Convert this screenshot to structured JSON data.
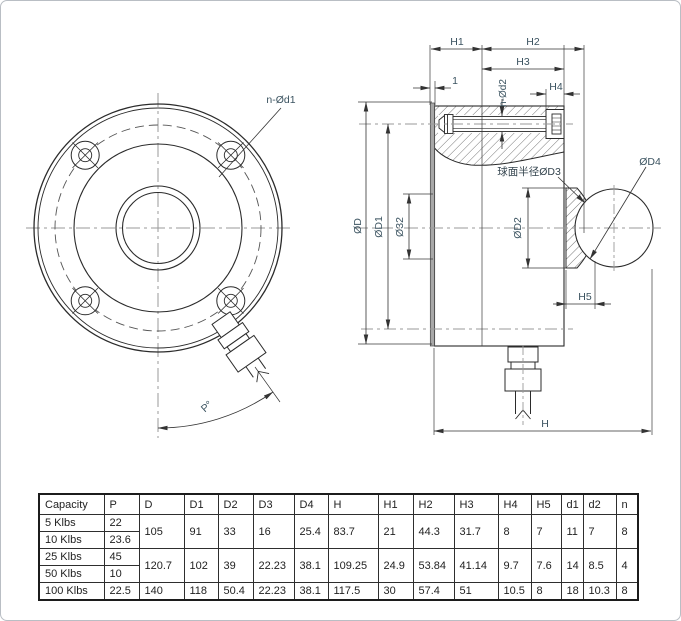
{
  "drawing": {
    "labels": {
      "n_d1": "n-Ød1",
      "p_angle": "P°",
      "h1": "H1",
      "h2": "H2",
      "h3": "H3",
      "h4": "H4",
      "h5": "H5",
      "h": "H",
      "one": "1",
      "n_d2": "n-Ød2",
      "dia_D": "ØD",
      "dia_D1": "ØD1",
      "dia_32": "Ø32",
      "dia_D2": "ØD2",
      "sphere_radius_d3": "球面半径ØD3",
      "dia_D4": "ØD4"
    },
    "icons": {
      "front_view": "circular-flange-front-view",
      "section_view": "sectional-side-view"
    }
  },
  "table": {
    "headers": [
      "Capacity",
      "P",
      "D",
      "D1",
      "D2",
      "D3",
      "D4",
      "H",
      "H1",
      "H2",
      "H3",
      "H4",
      "H5",
      "d1",
      "d2",
      "n"
    ],
    "groups": [
      {
        "capacities": [
          {
            "name": "5 Klbs",
            "p": "22"
          },
          {
            "name": "10 Klbs",
            "p": "23.6"
          }
        ],
        "shared": [
          "105",
          "91",
          "33",
          "16",
          "25.4",
          "83.7",
          "21",
          "44.3",
          "31.7",
          "8",
          "7",
          "11",
          "7",
          "8"
        ]
      },
      {
        "capacities": [
          {
            "name": "25 Klbs",
            "p": "45"
          },
          {
            "name": "50 Klbs",
            "p": "10"
          }
        ],
        "shared": [
          "120.7",
          "102",
          "39",
          "22.23",
          "38.1",
          "109.25",
          "24.9",
          "53.84",
          "41.14",
          "9.7",
          "7.6",
          "14",
          "8.5",
          "4"
        ]
      },
      {
        "capacities": [
          {
            "name": "100 Klbs",
            "p": "22.5"
          }
        ],
        "shared": [
          "140",
          "118",
          "50.4",
          "22.23",
          "38.1",
          "117.5",
          "30",
          "57.4",
          "51",
          "10.5",
          "8",
          "18",
          "10.3",
          "8"
        ]
      }
    ]
  },
  "colors": {
    "object_line": "#2b2b2b",
    "dim_line": "#3a3a3a",
    "centerline": "#9a9a9a",
    "dim_text": "#3b5360",
    "table_text": "#1f1f1f"
  }
}
